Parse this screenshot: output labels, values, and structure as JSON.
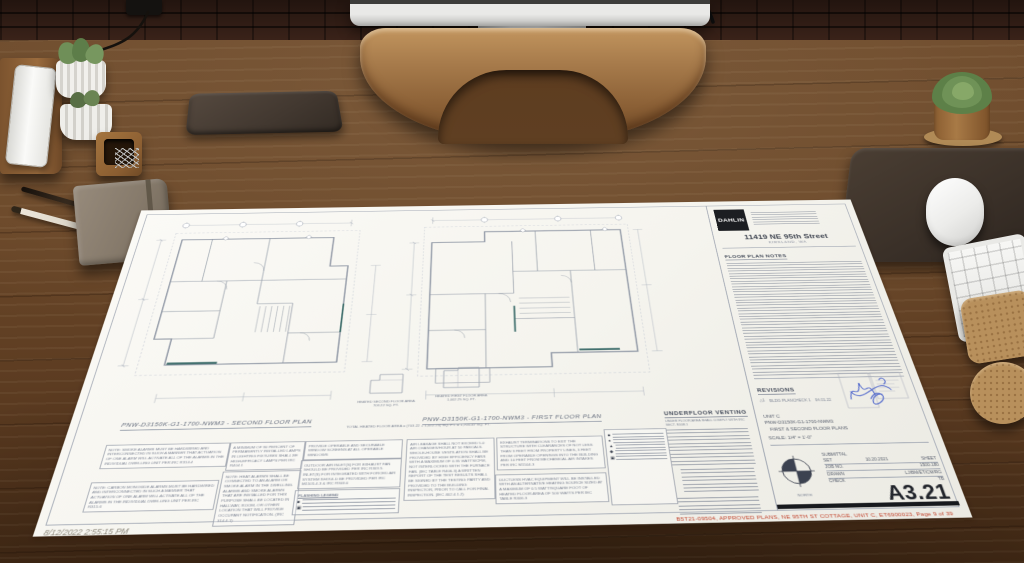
{
  "sheet": {
    "brand": "DAHLIN",
    "project_address": "11419 NE 95th Street",
    "project_city": "KIRKLAND, WA",
    "floor_plan_notes_title": "FLOOR PLAN NOTES",
    "second_plan_title": "PNW-D3150K-G1-1700-NWM3 - SECOND FLOOR PLAN",
    "first_plan_title": "PNW-D3150K-G1-1700-NWM3 - FIRST FLOOR PLAN",
    "heated_second_area": "HEATED SECOND FLOOR AREA 703.22 SQ. FT.",
    "heated_first_area": "HEATED FIRST FLOOR AREA 1,002.25 SQ. FT.",
    "total_heated_area": "TOTAL HEATED FLOOR AREA = (703.22 + 1,002.25) SQ. FT. = 1,705.47 SQ. FT.",
    "underfloor_venting_title": "UNDERFLOOR VENTING",
    "underfloor_venting_subtitle": "UNDER FLOOR AREA SHALL COMPLY WITH IRC SECT. R408.1",
    "flashing_legend_title": "FLASHING LEGEND",
    "notes": [
      "NOTE: SMOKE ALARMS MUST BE HARDWIRED AND INTERCONNECTED IN SUCH A MANNER THAT ACTUATION OF ONE ALARM WILL ACTIVATE ALL OF THE ALARMS IN THE INDIVIDUAL DWELLING UNIT PER IRC R314.4",
      "NOTE: CARBON MONOXIDE ALARMS MUST BE HARDWIRED AND INTERCONNECTED IN SUCH A MANNER THAT ACTUATION OF ONE ALARM WILL ACTIVATE ALL OF THE ALARMS IN THE INDIVIDUAL DWELLING UNIT PER IRC R315.6",
      "A MINIMUM OF 90 PERCENT OF PERMANENTLY INSTALLED LAMPS IN LIGHTING FIXTURES SHALL BE HIGH-EFFICACY LAMPS PER IRC R404.1",
      "NOTE: HEAT ALARMS SHALL BE CONNECTED TO AN ALARM OR SMOKE ALARM IN THE DWELLING. ALARMS AND SMOKE ALARMS THAT ARE INSTALLED FOR THIS PURPOSE SHALL BE LOCATED IN HALLWAY, ROOM, OR OTHER LOCATION THAT WILL PROVIDE OCCUPANT NOTIFICATION. (IRC 314.4.1)",
      "PROVIDE OPERABLE AND SECURABLE WINDOW SCREENS AT ALL OPERABLE WINDOWS",
      "OUTDOOR AIR INLET(S) FOR EXHAUST FAN SHOULD BE PROVIDED PER IRC R303.5. INLET(S) FOR INTEGRATED WITH FORCED AIR SYSTEM SHOULD BE PROVIDED PER IRC M1505.4.3 & IRC R303.6",
      "AIR LEAKAGE SHALL NOT EXCEED 5.0 AIR CHANGES/HOUR AT 50 PASCALS. WHOLE-HOUSE VENTILATION SHALL BE PROVIDED BY HIGH EFFICIENCY FANS WITH A MAXIMUM OF 0.35 WATTS/CFM, NOT INTERLOCKED WITH THE FURNACE FAN. (IEC TABLE R406.3) A WRITTEN REPORT OF THE TEST RESULTS SHALL BE SIGNED BY THE TESTING PARTY AND PROVIDED TO THE BUILDING INSPECTOR, PRIOR TO CALL FOR FINAL INSPECTION. (IEC 402.4.1.2)",
      "EXHAUST TERMINATIONS TO EXIT THE STRUCTURE WITH CLEARANCES OF NOT LESS THAN 3 FEET FROM PROPERTY LINES, 3 FEET FROM OPERABLE OPENINGS INTO THE BUILDING AND 10 FEET FROM MECHANICAL AIR INTAKES PER IRC M1504.3",
      "DUCTLESS HVAC EQUIPMENT WILL BE INSTALLED WITH AN ALTERNATIVE HEATING SOURCE SIZED AT A MAXIMUM OF 0.5 WATT/SQUARE FOOT OF HEATED FLOOR AREA OF 500 WATTS PER IEC TABLE R406.3"
    ],
    "keyed_symbols": [
      "■",
      "●",
      "▲",
      "◆",
      "▣"
    ],
    "revisions_title": "REVISIONS",
    "revision_marker": "△1",
    "revision_entry": "BLDG PLANCHECK 1",
    "revision_date": "04.01.22",
    "unit": "UNIT C",
    "model": "PNW-D3150K-G1-1700-NWM3",
    "unit_sheets": "FIRST & SECOND FLOOR PLANS",
    "scale": "SCALE: 1/4\" = 1'-0\"",
    "submittal_title": "SUBMITTAL",
    "set_label": "SET",
    "set_value": "10.20.2021",
    "sheet_label": "SHEET",
    "job_label": "JOB NO.",
    "job_value": "1500.180",
    "drawn_label": "DRAWN",
    "drawn_value": "LJ/BM/ET/CM/RG",
    "check_label": "CHECK",
    "check_value": "TB",
    "sheet_number": "A3.21",
    "north_label": "NORTH",
    "approval_text": "B5T21-09504, APPROVED PLANS, NE 95TH ST COTTAGE, UNIT C, ET6900023, Page 9 of 39",
    "timestamp": "8/12/2022 2:55:15 PM"
  },
  "colors": {
    "paper": "#f6f5f0",
    "drawing_line": "#8e96a4",
    "teal_accent": "#42706e",
    "stamp_blue": "#3a55c8",
    "approval_red": "#c2452e",
    "desk_wood": "#6b4a2c",
    "stand_wood": "#a97e4e"
  }
}
